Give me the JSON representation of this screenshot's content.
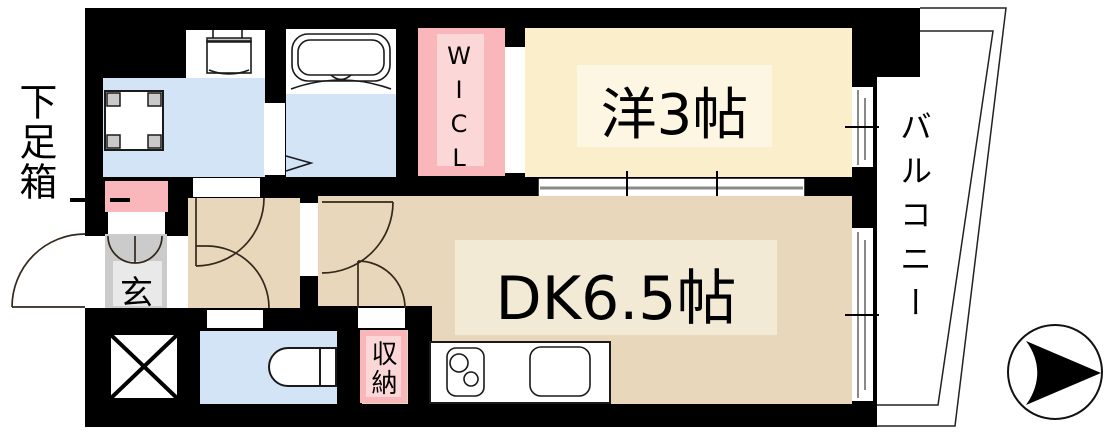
{
  "labels": {
    "shoe_box": "下足箱",
    "genkan": "玄",
    "walk_in_closet": "WICL",
    "western_room": "洋3帖",
    "dining_kitchen": "DK6.5帖",
    "storage": "収納",
    "balcony": "バルコニー"
  },
  "compass": {
    "arrow_direction": "right"
  },
  "colors": {
    "wall": "#000000",
    "room_cream": "#faeecb",
    "room_cream_light": "#fdf6e2",
    "room_beige": "#e8d7ba",
    "room_beige_light": "#f3ead6",
    "pink": "#f9b7bb",
    "pink_light": "#fcd7d8",
    "blue": "#d2e4f6",
    "gray_dark": "#cbcbcb",
    "gray_light": "#e9e9e9",
    "window_line": "#8a8a8a",
    "door_line": "#33281c"
  }
}
